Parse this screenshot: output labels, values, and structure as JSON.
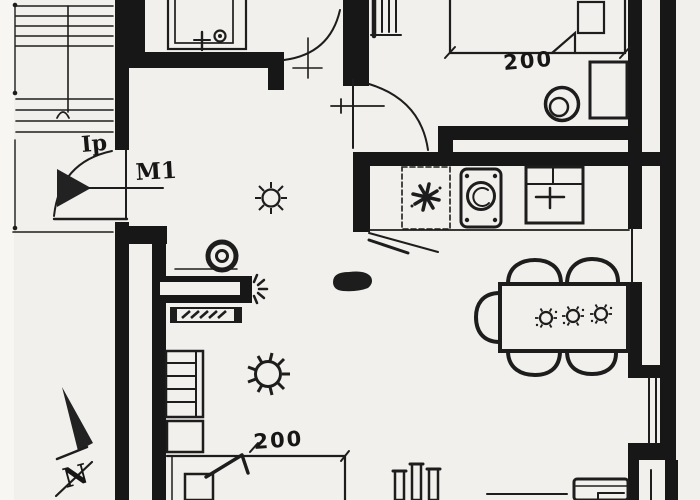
{
  "colors": {
    "paper": "#f2f0ec",
    "ink": "#1d1d1d",
    "wall": "#171717"
  },
  "annotations": {
    "entry_door_label": "Ip",
    "wall_type_label": "M1",
    "bed_top_width": "200",
    "bed_bottom_width": "200",
    "north_letter": "N"
  }
}
